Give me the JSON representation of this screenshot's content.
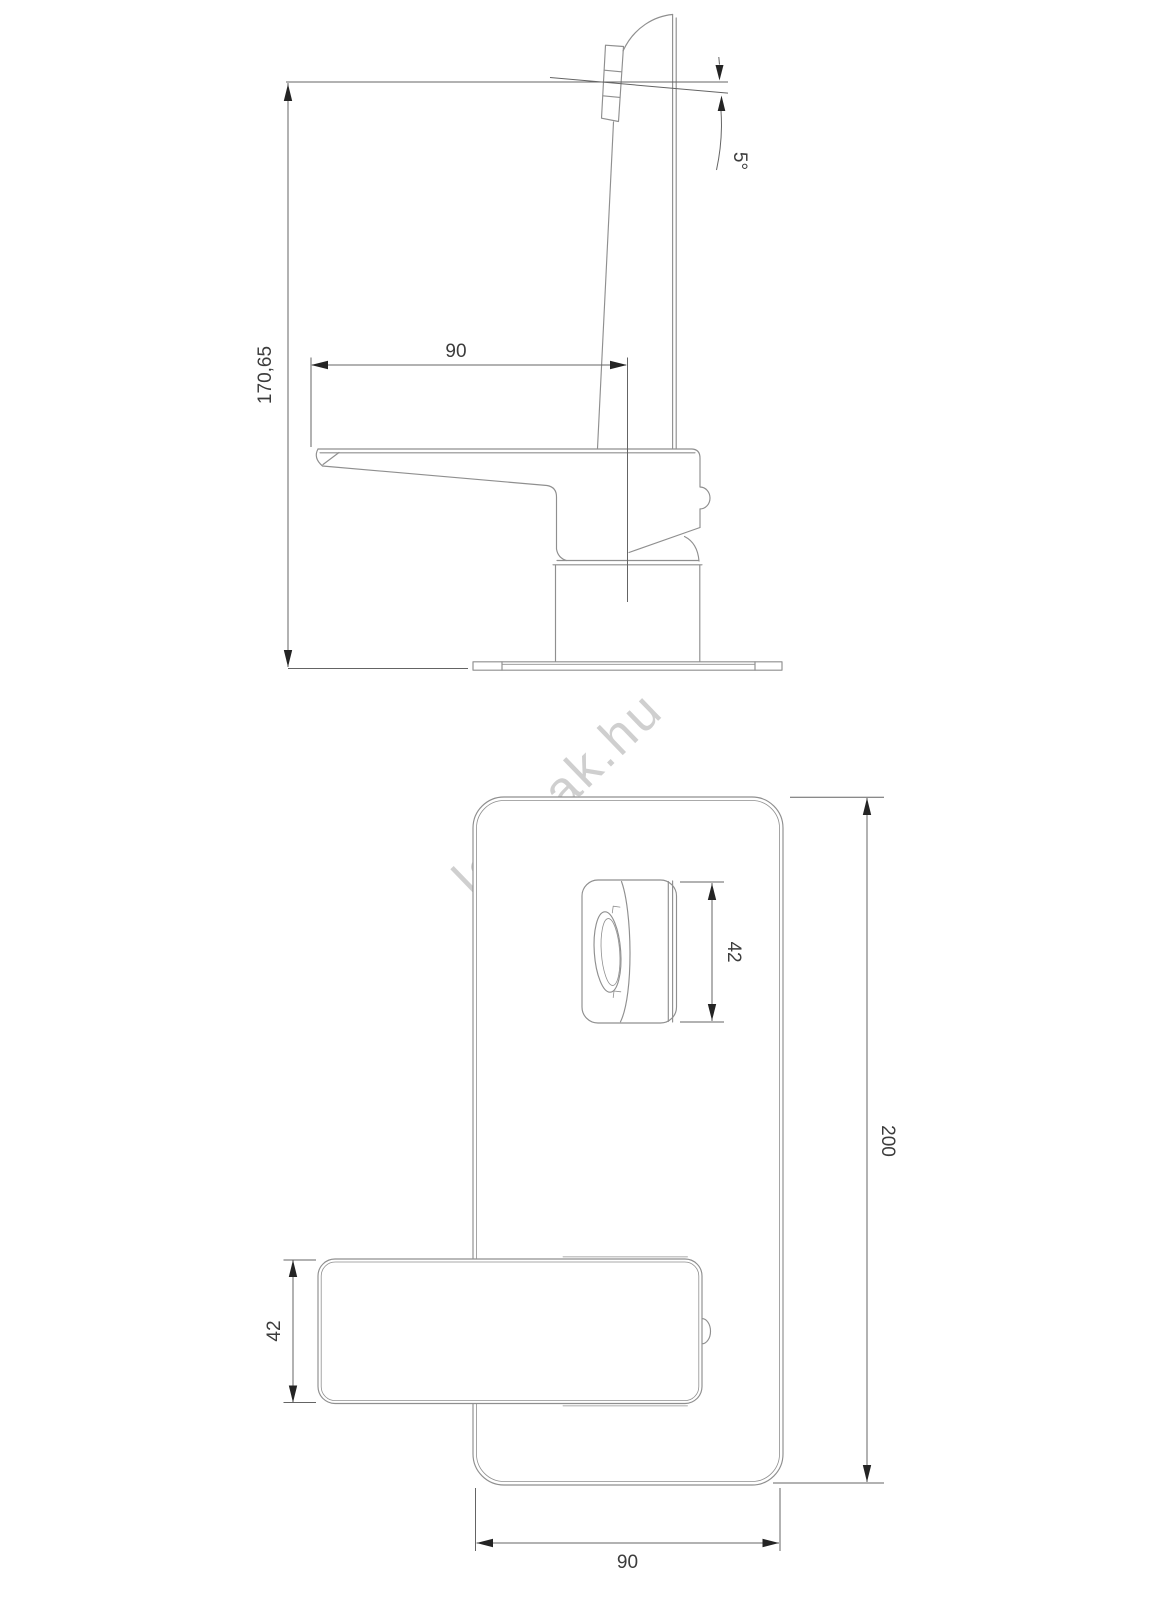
{
  "drawing": {
    "colors": {
      "background": "#ffffff",
      "outline": "#8f8f8f",
      "dimension_line": "#646464",
      "dimension_text": "#3c3c3c",
      "arrow": "#242424",
      "watermark": "#c7c7c7"
    },
    "side_view": {
      "dim_height": "170,65",
      "dim_reach": "90",
      "dim_angle": "5°"
    },
    "top_view": {
      "dim_spout_width": "42",
      "dim_plate_length": "200",
      "dim_handle_width": "42",
      "dim_plate_width": "90"
    }
  },
  "watermark": {
    "text": "lampak.hu"
  }
}
